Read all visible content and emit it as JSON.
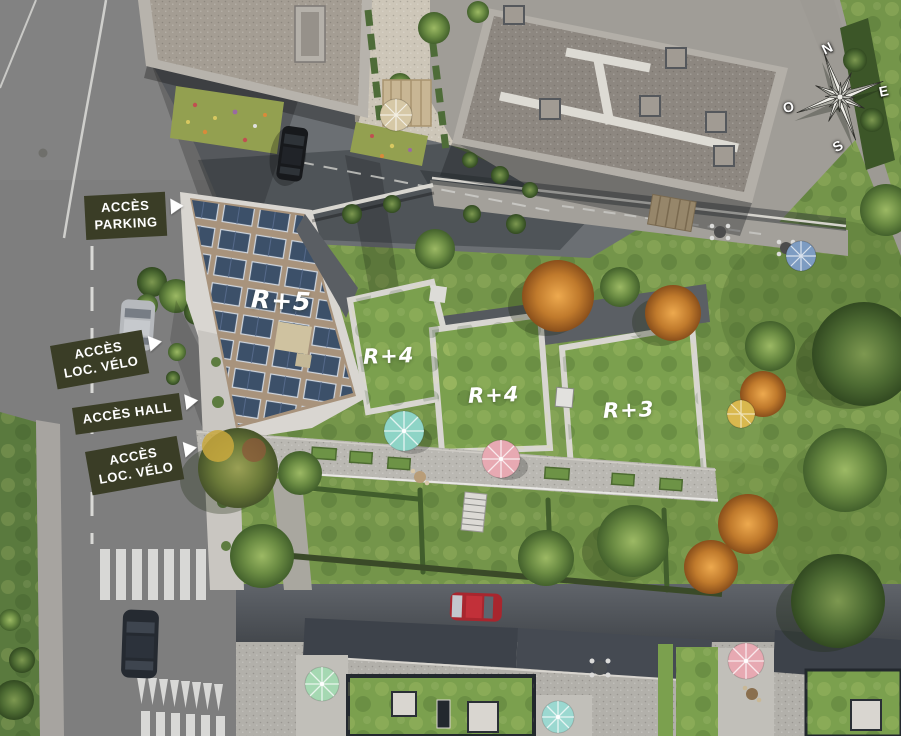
{
  "plan": {
    "type": "residential-site-plan-aerial",
    "access_labels": [
      {
        "id": "parking",
        "lines": [
          "ACCÈS",
          "PARKING"
        ]
      },
      {
        "id": "loc-velo-1",
        "lines": [
          "ACCÈS",
          "LOC. VÉLO"
        ]
      },
      {
        "id": "hall",
        "lines": [
          "ACCÈS HALL"
        ]
      },
      {
        "id": "loc-velo-2",
        "lines": [
          "ACCÈS",
          "LOC. VÉLO"
        ]
      }
    ],
    "building_labels": [
      {
        "id": "r5",
        "text": "R+5"
      },
      {
        "id": "r4a",
        "text": "R+4"
      },
      {
        "id": "r4b",
        "text": "R+4"
      },
      {
        "id": "r3",
        "text": "R+3"
      }
    ],
    "compass": {
      "north": "N",
      "east": "E",
      "south": "S",
      "west": "O"
    },
    "colors": {
      "label_background": "#3a3d26",
      "label_text": "#ffffff",
      "building_label_text": "#ffffff",
      "grass": "#74954a",
      "road": "#7e7e7e",
      "green_roof": "#7ba04e",
      "solar_panel": "#3c5069",
      "gravel_roof": "#a8937c",
      "umbrella_teal": "#8ed4c6",
      "umbrella_pink": "#e7a9b2",
      "umbrella_blue": "#7d9cc2",
      "umbrella_yellow": "#d9b84e",
      "umbrella_mint": "#a5d8b2",
      "umbrella_aqua": "#9bd8d0",
      "umbrella_tan": "#d6c8a6"
    }
  }
}
